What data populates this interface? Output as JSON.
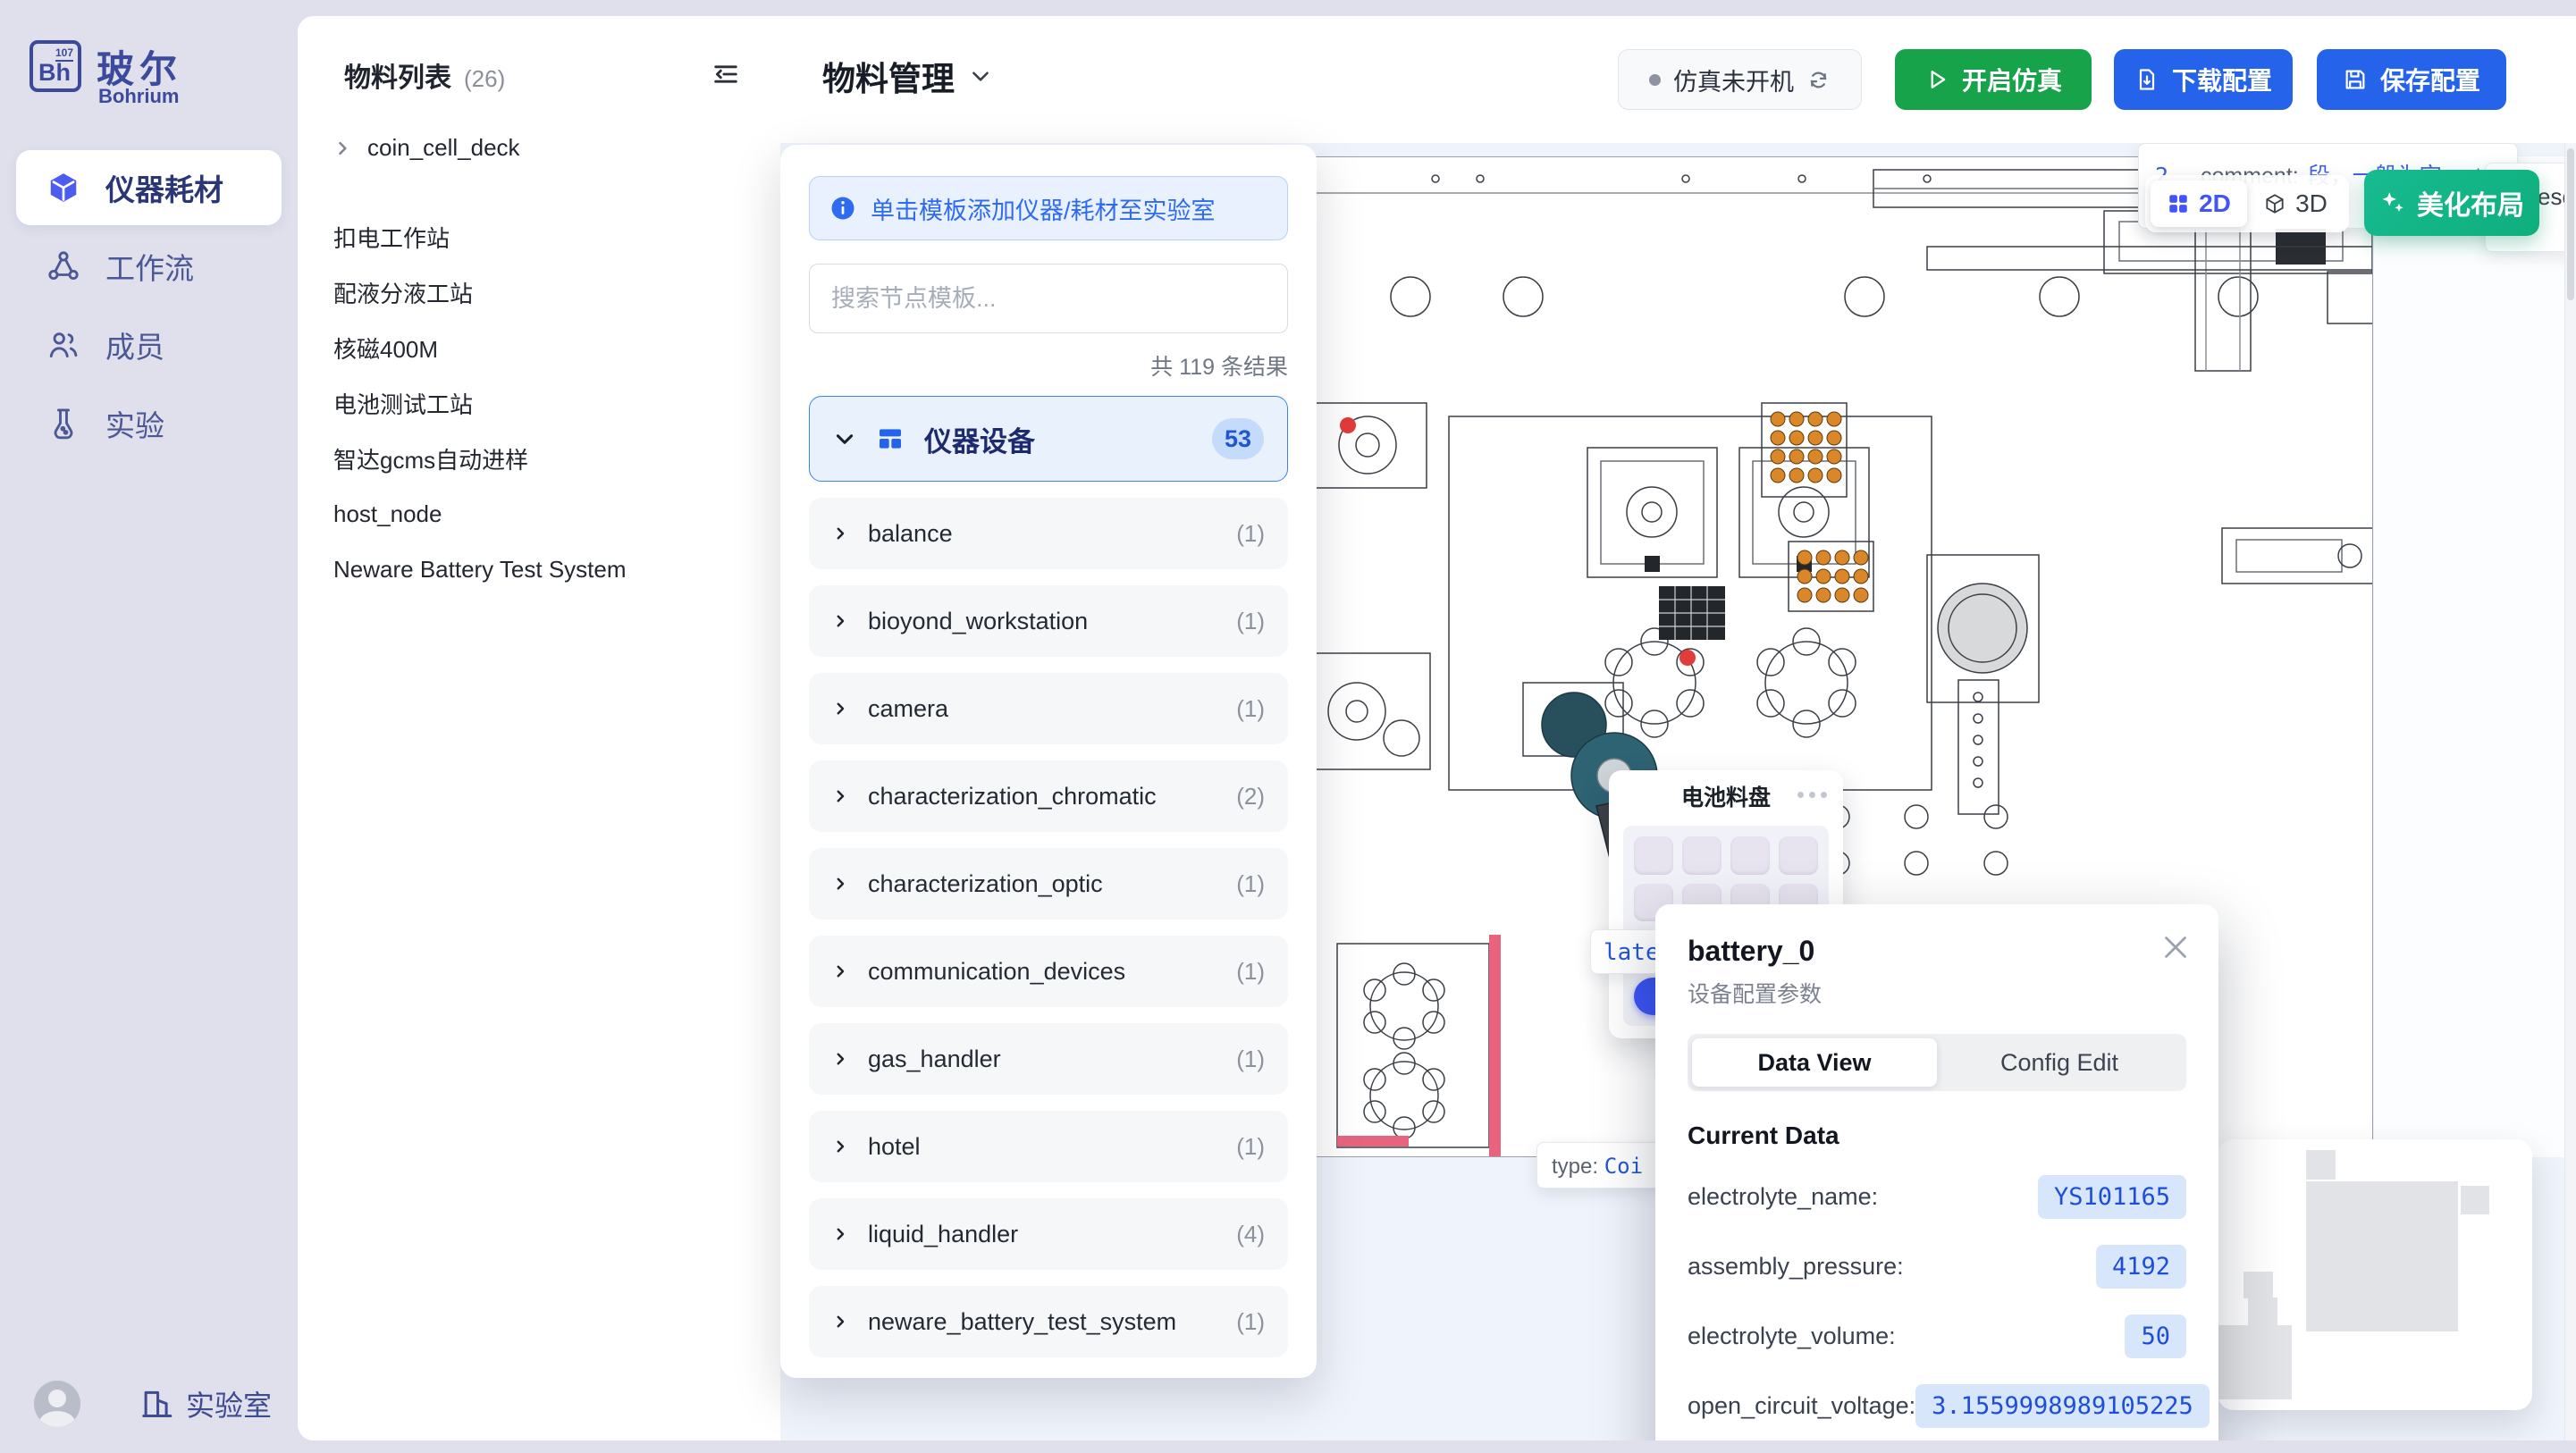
{
  "sidebar": {
    "brand": {
      "element_number": "107",
      "symbol": "Bh",
      "name_cn": "玻尔",
      "name_en": "Bohrium"
    },
    "items": [
      {
        "label": "仪器耗材"
      },
      {
        "label": "工作流"
      },
      {
        "label": "成员"
      },
      {
        "label": "实验"
      }
    ],
    "footer": {
      "lab_label": "实验室"
    }
  },
  "material_panel": {
    "title": "物料列表",
    "count": "(26)",
    "root_item": "coin_cell_deck",
    "items": [
      "扣电工作站",
      "配液分液工站",
      "核磁400M",
      "电池测试工站",
      "智达gcms自动进样",
      "host_node",
      "Neware Battery Test System"
    ]
  },
  "topbar": {
    "title": "物料管理",
    "status_label": "仿真未开机",
    "start_button": "开启仿真",
    "download_button": "下载配置",
    "save_button": "保存配置"
  },
  "template_panel": {
    "hint": "单击模板添加仪器/耗材至实验室",
    "search_placeholder": "搜索节点模板...",
    "result_count": "共 119 条结果",
    "category": {
      "label": "仪器设备",
      "badge": "53"
    },
    "items": [
      {
        "label": "balance",
        "count": "(1)"
      },
      {
        "label": "bioyond_workstation",
        "count": "(1)"
      },
      {
        "label": "camera",
        "count": "(1)"
      },
      {
        "label": "characterization_chromatic",
        "count": "(2)"
      },
      {
        "label": "characterization_optic",
        "count": "(1)"
      },
      {
        "label": "communication_devices",
        "count": "(1)"
      },
      {
        "label": "gas_handler",
        "count": "(1)"
      },
      {
        "label": "hotel",
        "count": "(1)"
      },
      {
        "label": "liquid_handler",
        "count": "(4)"
      },
      {
        "label": "neware_battery_test_system",
        "count": "(1)"
      }
    ]
  },
  "canvas": {
    "toggle": {
      "two_d": "2D",
      "three_d": "3D"
    },
    "beautify_button": "美化布局",
    "comment_partial": {
      "prefix": "2",
      "key": "_comment:",
      "value": "段，一般为空，stat"
    },
    "resource_partial": "esou",
    "tray_card": {
      "title": "电池料盘"
    },
    "plate_partial": "late",
    "type_partial": {
      "key": "type:",
      "value": "Coi"
    }
  },
  "popup": {
    "title": "battery_0",
    "subtitle": "设备配置参数",
    "tabs": {
      "active": "Data View",
      "inactive": "Config Edit"
    },
    "section_title": "Current Data",
    "fields": [
      {
        "label": "electrolyte_name:",
        "value": "YS101165"
      },
      {
        "label": "assembly_pressure:",
        "value": "4192"
      },
      {
        "label": "electrolyte_volume:",
        "value": "50"
      },
      {
        "label": "open_circuit_voltage:",
        "value": "3.1559998989105225"
      },
      {
        "label": "data_electrolyte_code:",
        "value": "LG000014"
      }
    ]
  },
  "colors": {
    "accent_blue": "#2563eb",
    "green": "#16a34a",
    "teal": "#10b981",
    "active_icon": "#4c5bf0"
  }
}
